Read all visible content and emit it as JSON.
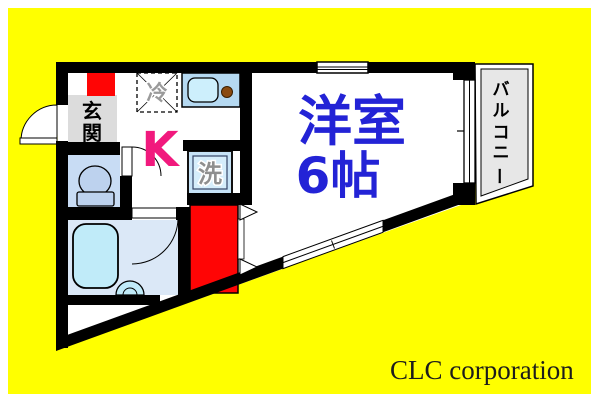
{
  "page": {
    "brand_text": "CLC corporation"
  },
  "floorplan": {
    "labels": {
      "entrance_chars": [
        "玄",
        "関"
      ],
      "kitchen": "K",
      "refrigerator": "冷",
      "washing_machine": "洗",
      "western_room": "洋室",
      "western_room_size": "6帖",
      "balcony_chars": [
        "バ",
        "ル",
        "コ",
        "ニ",
        "ー"
      ]
    },
    "colors": {
      "background_yellow": "#ffff00",
      "highlight_red": "#ff0505",
      "kitchen_pink": "#f1197d",
      "room_label_blue": "#2323d6",
      "wall_black": "#000000",
      "bathtub_blue": "#c0ebf9",
      "floor_blue": "#dbe8f7",
      "balcony_gray": "#e7e7e7",
      "entrance_mat_gray": "#dcdcdc",
      "appliance_label_gray": "#8f8f8f"
    }
  }
}
